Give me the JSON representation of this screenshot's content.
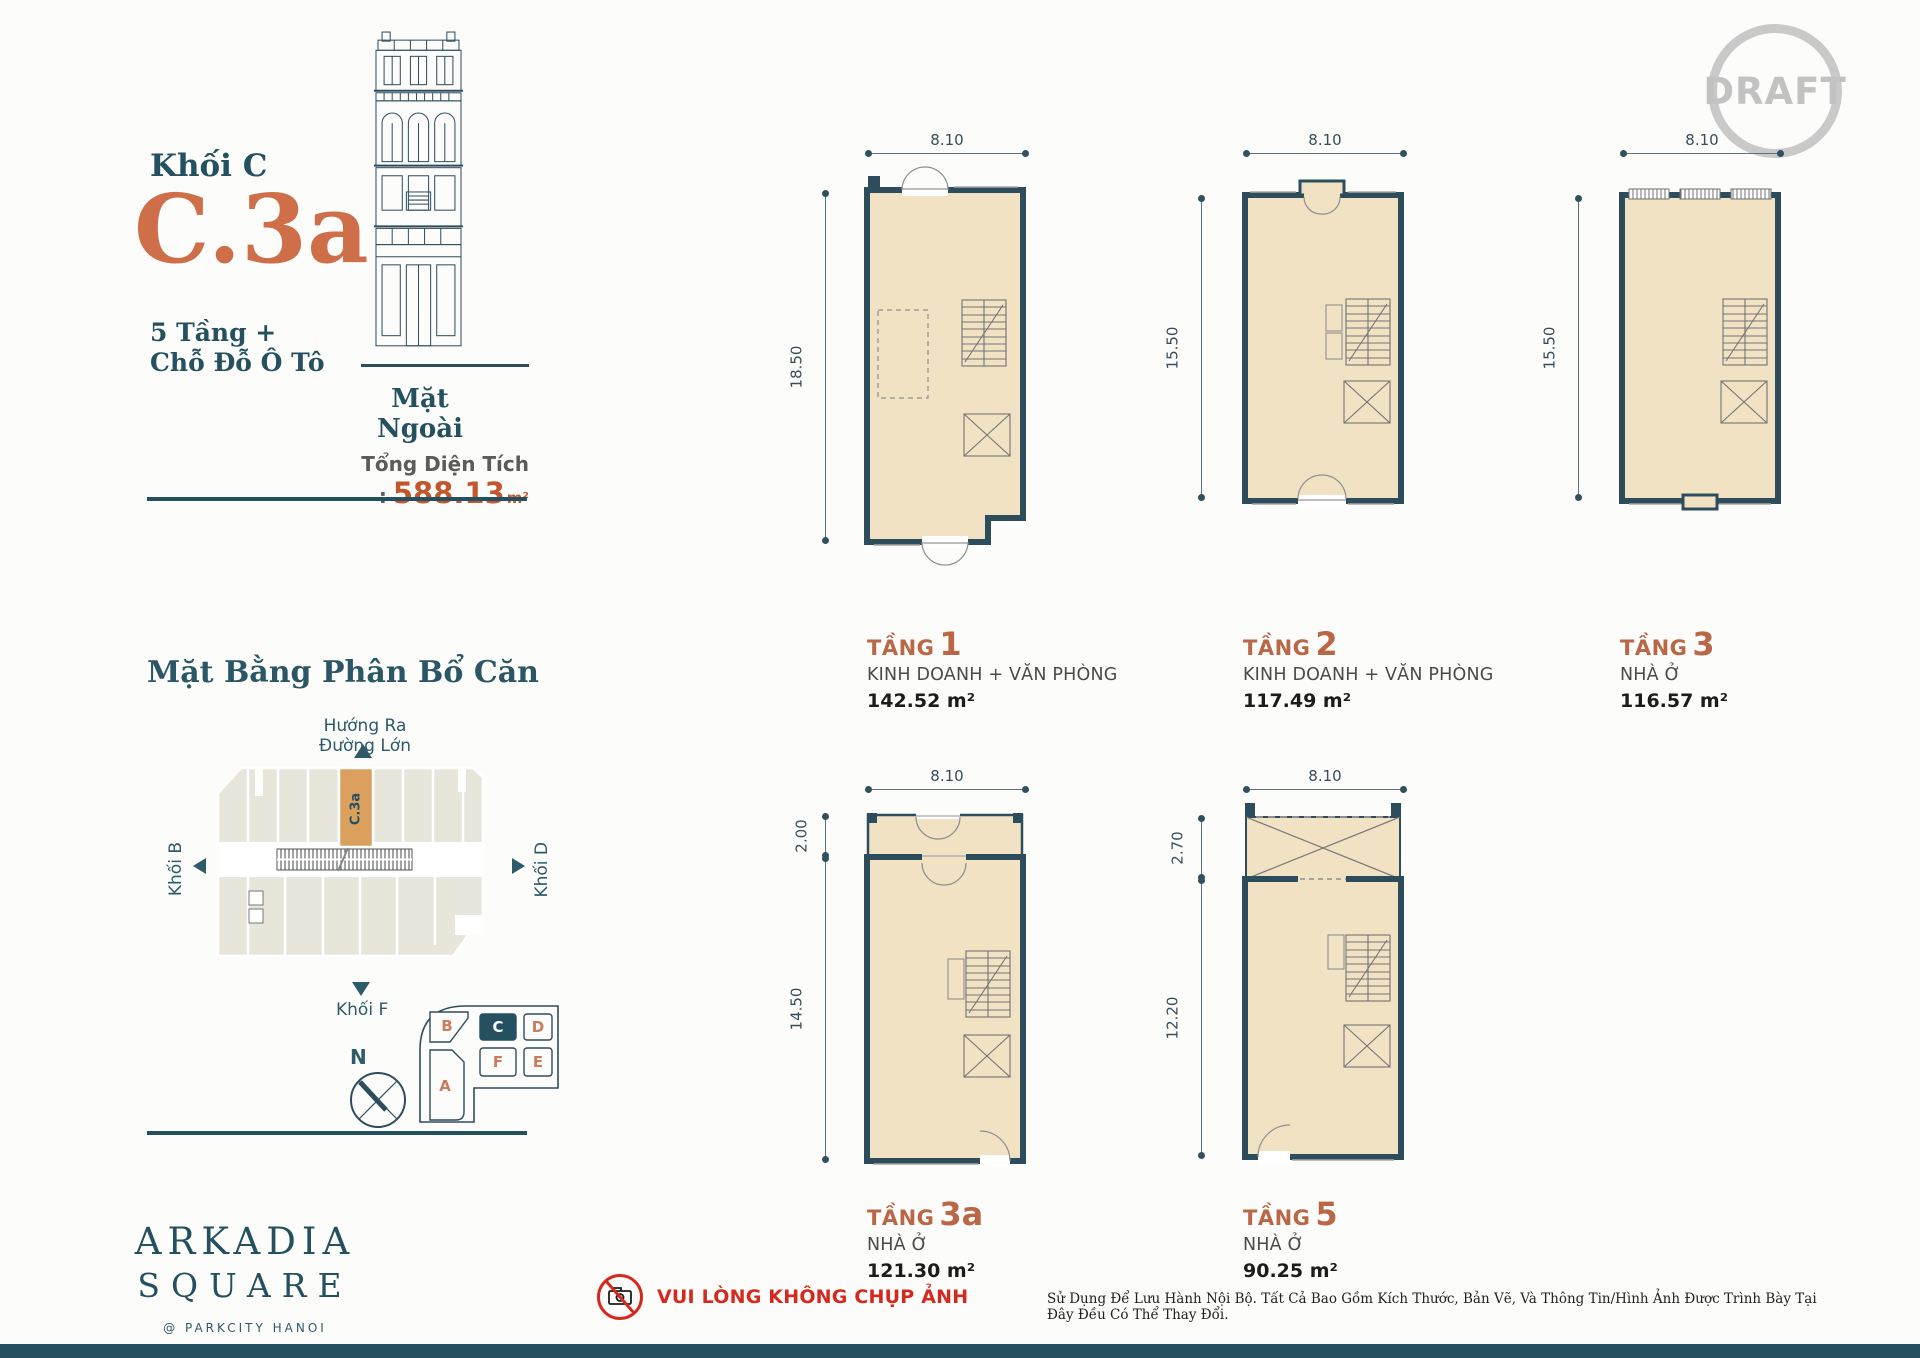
{
  "header": {
    "draft_stamp": "DRAFT"
  },
  "unit_info": {
    "block_label": "Khối C",
    "unit_code": "C.3a",
    "floors_line1": "5 Tầng +",
    "floors_line2": "Chỗ Đỗ Ô Tô",
    "elevation_caption": "Mặt Ngoài",
    "total_area_label": "Tổng Diện Tích :",
    "total_area_value": "588.13",
    "total_area_unit": "m²"
  },
  "site_plan": {
    "heading": "Mặt Bằng Phân Bổ Căn",
    "direction_note": "Hướng Ra Đường Lớn",
    "block_left_label": "Khối B",
    "block_right_label": "Khối D",
    "block_bottom_label": "Khối F",
    "highlighted_unit_label": "C.3a",
    "compass_label": "N",
    "key_plan": {
      "blocks": [
        "B",
        "C",
        "D",
        "F",
        "E",
        "A"
      ],
      "selected": "C"
    },
    "highlight_color": "#dca05e"
  },
  "floor_plans": [
    {
      "floor_label": "TẦNG",
      "floor_number": "1",
      "use_label": "KINH DOANH + VĂN PHÒNG",
      "area_label": "142.52 m²",
      "width_dim": "8.10",
      "height_dim": "18.50"
    },
    {
      "floor_label": "TẦNG",
      "floor_number": "2",
      "use_label": "KINH DOANH + VĂN PHÒNG",
      "area_label": "117.49 m²",
      "width_dim": "8.10",
      "height_dim": "15.50"
    },
    {
      "floor_label": "TẦNG",
      "floor_number": "3",
      "use_label": "NHÀ Ở",
      "area_label": "116.57 m²",
      "width_dim": "8.10",
      "height_dim": "15.50"
    },
    {
      "floor_label": "TẦNG",
      "floor_number": "3a",
      "use_label": "NHÀ Ở",
      "area_label": "121.30 m²",
      "width_dim": "8.10",
      "height_dim_upper": "2.00",
      "height_dim_lower": "14.50"
    },
    {
      "floor_label": "TẦNG",
      "floor_number": "5",
      "use_label": "NHÀ Ở",
      "area_label": "90.25 m²",
      "width_dim": "8.10",
      "height_dim_upper": "2.70",
      "height_dim_lower": "12.20"
    }
  ],
  "brand": {
    "name_line1": "ARKADIA",
    "name_line2": "SQUARE",
    "tagline": "@ PARKCITY HANOI"
  },
  "footer": {
    "no_photo_warning": "VUI LÒNG KHÔNG CHỤP ẢNH",
    "disclaimer": "Sử Dụng Để Lưu Hành Nội Bộ. Tất Cả Bao Gồm Kích Thước, Bản Vẽ, Và Thông Tin/Hình Ảnh Được Trình Bày Tại Đây Đều Có Thể Thay Đổi."
  },
  "colors": {
    "teal": "#24505f",
    "orange": "#cf6f4a",
    "floor_fill": "#f2e2c4",
    "wall": "#2e4d5c",
    "site_fill": "#e8e6da",
    "highlight": "#dca05e",
    "draft_gray": "#c9c9c9",
    "warning_red": "#d5291f"
  }
}
